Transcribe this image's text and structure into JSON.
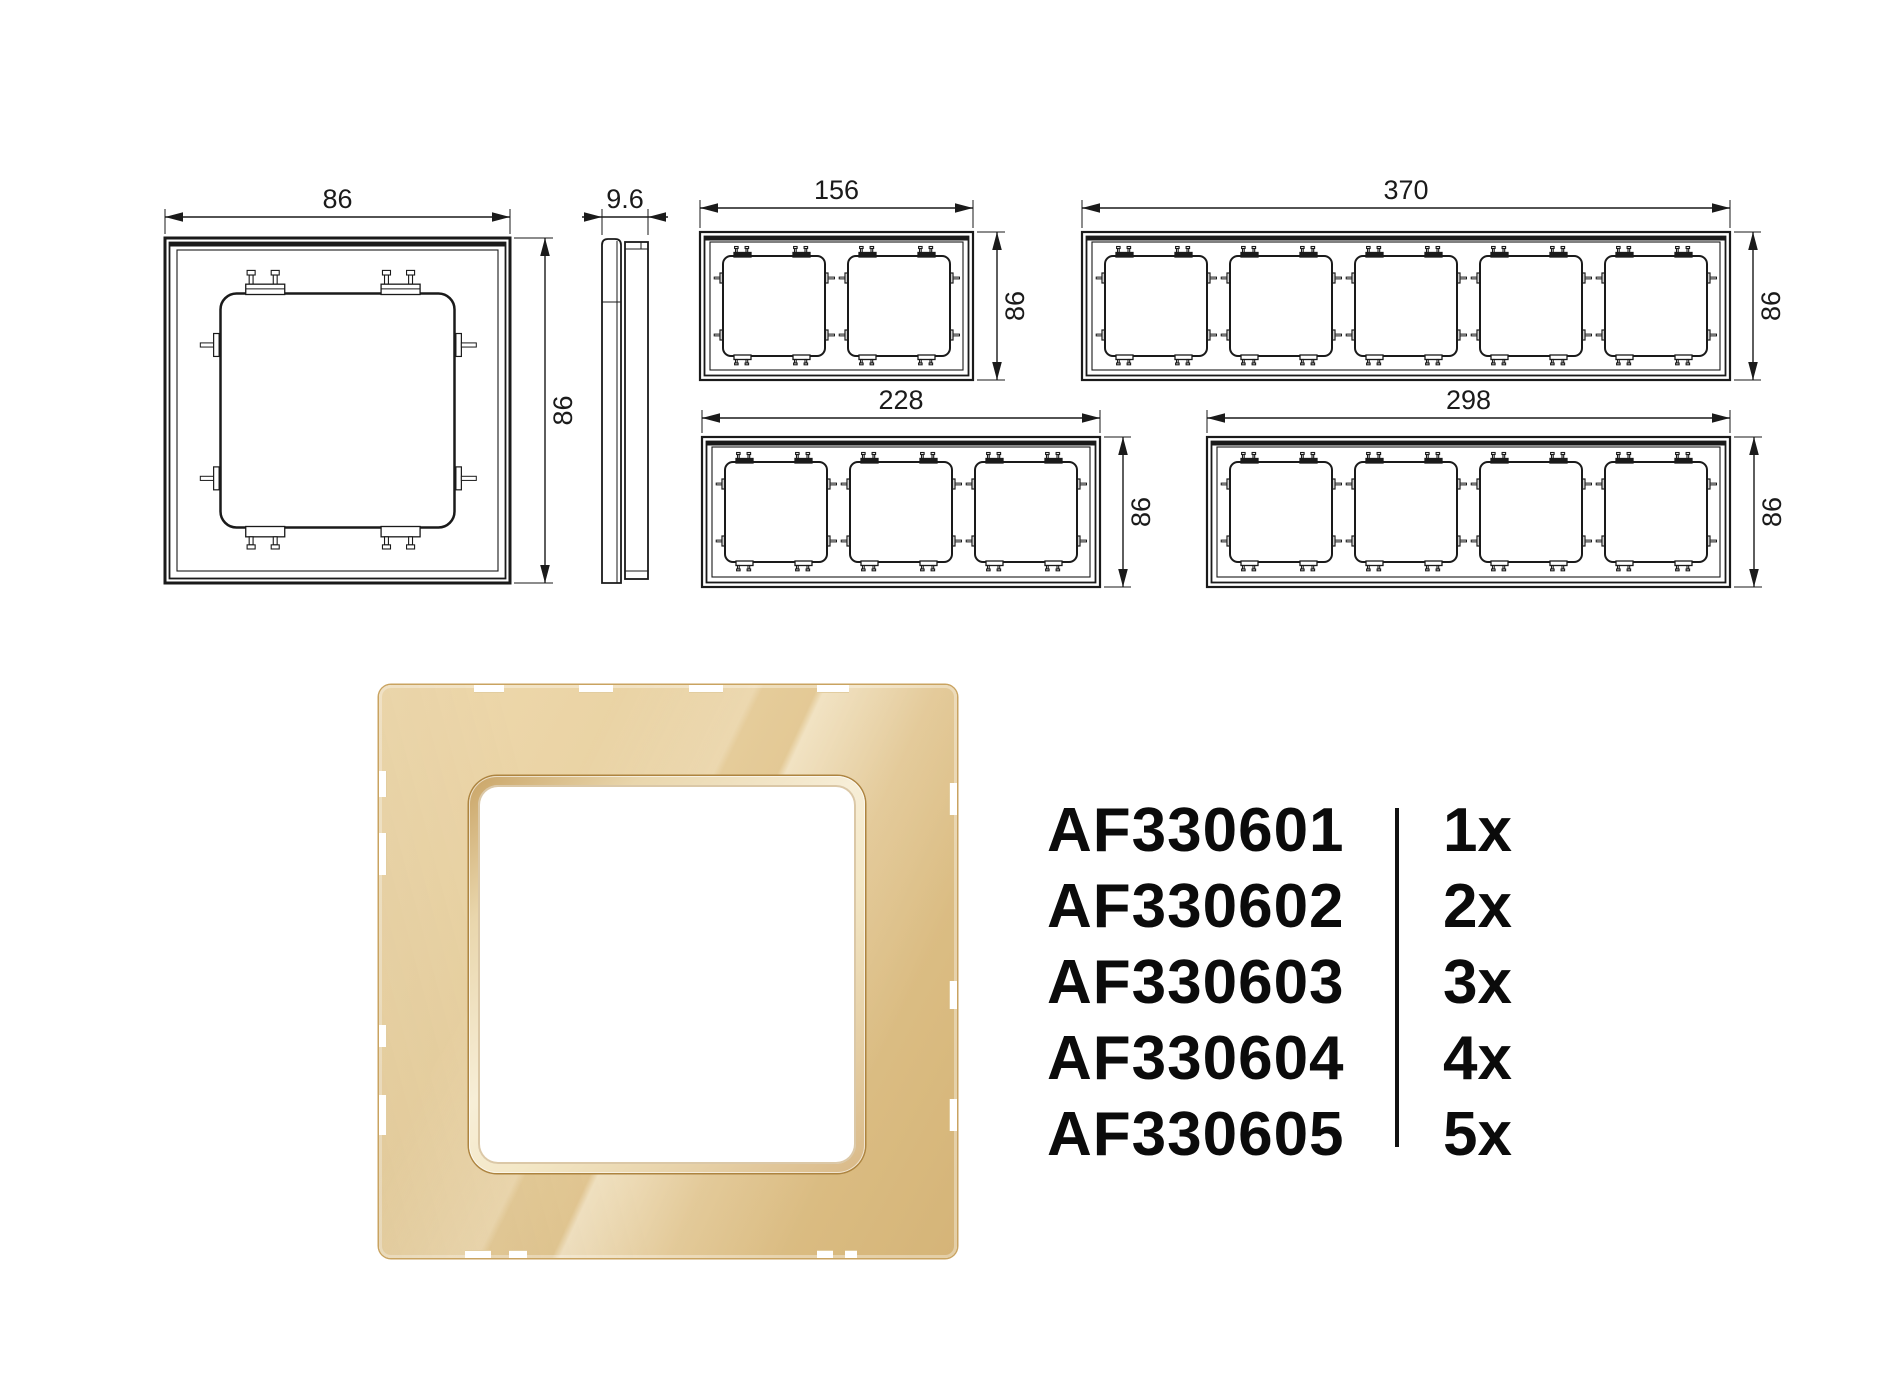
{
  "colors": {
    "line": "#1a1a1a",
    "text": "#0b0b0b",
    "background": "#ffffff",
    "gold_light": "#eed9ae",
    "gold_mid": "#e4ca97",
    "gold_dark": "#d5b478",
    "gold_edge": "#c9a360"
  },
  "technical": {
    "dim_font_size": 27,
    "frames": [
      {
        "name": "frame-1gang",
        "gangs": 1,
        "x": 165,
        "y": 238,
        "w": 345,
        "h": 345,
        "dim_top": "86",
        "dim_top_y": 217,
        "dim_right": "86",
        "dim_right_x": 545,
        "opening": {
          "w": 234,
          "h": 234,
          "margin": 55.5,
          "gap": 0
        },
        "tab_style": "outline"
      },
      {
        "name": "frame-2gang",
        "gangs": 2,
        "x": 700,
        "y": 232,
        "w": 273,
        "h": 148,
        "dim_top": "156",
        "dim_top_y": 208,
        "dim_right": "86",
        "dim_right_x": 997,
        "opening": {
          "w": 102,
          "h": 100,
          "margin": 23,
          "gap": 23
        },
        "tab_style": "filled"
      },
      {
        "name": "frame-5gang",
        "gangs": 5,
        "x": 1082,
        "y": 232,
        "w": 648,
        "h": 148,
        "dim_top": "370",
        "dim_top_y": 208,
        "dim_right": "86",
        "dim_right_x": 1753,
        "opening": {
          "w": 102,
          "h": 100,
          "margin": 23,
          "gap": 23
        },
        "tab_style": "filled"
      },
      {
        "name": "frame-3gang",
        "gangs": 3,
        "x": 702,
        "y": 437,
        "w": 398,
        "h": 150,
        "dim_top": "228",
        "dim_top_y": 418,
        "dim_right": "86",
        "dim_right_x": 1123,
        "opening": {
          "w": 102,
          "h": 100,
          "margin": 23,
          "gap": 23
        },
        "tab_style": "filled"
      },
      {
        "name": "frame-4gang",
        "gangs": 4,
        "x": 1207,
        "y": 437,
        "w": 523,
        "h": 150,
        "dim_top": "298",
        "dim_top_y": 418,
        "dim_right": "86",
        "dim_right_x": 1754,
        "opening": {
          "w": 102,
          "h": 100,
          "margin": 23,
          "gap": 23
        },
        "tab_style": "filled"
      }
    ],
    "profile": {
      "name": "profile-view",
      "x": 602,
      "y": 239,
      "w": 46,
      "h": 344,
      "dim_top": "9.6",
      "dim_top_y": 217
    }
  },
  "render": {
    "x": 379,
    "y": 685,
    "w": 578,
    "h": 573,
    "bevel": {
      "x": 90,
      "y": 91,
      "w": 396,
      "h": 397
    },
    "notches": {
      "top": [
        {
          "x": 95,
          "w": 30
        },
        {
          "x": 200,
          "w": 34
        },
        {
          "x": 310,
          "w": 34
        },
        {
          "x": 438,
          "w": 32
        }
      ],
      "bottom": [
        {
          "x": 86,
          "w": 26
        },
        {
          "x": 130,
          "w": 18
        },
        {
          "x": 438,
          "w": 16
        },
        {
          "x": 466,
          "w": 12
        }
      ],
      "left": [
        {
          "y": 86,
          "h": 26
        },
        {
          "y": 148,
          "h": 42
        },
        {
          "y": 340,
          "h": 22
        },
        {
          "y": 410,
          "h": 40
        }
      ],
      "right": [
        {
          "y": 98,
          "h": 32
        },
        {
          "y": 296,
          "h": 28
        },
        {
          "y": 414,
          "h": 32
        }
      ]
    }
  },
  "code_list": {
    "x": 1047,
    "y": 792,
    "row_height": 76,
    "divider": {
      "x": 348,
      "top": 16,
      "width": 4,
      "height": 339
    },
    "items": [
      {
        "code": "AF330601",
        "qty": "1x"
      },
      {
        "code": "AF330602",
        "qty": "2x"
      },
      {
        "code": "AF330603",
        "qty": "3x"
      },
      {
        "code": "AF330604",
        "qty": "4x"
      },
      {
        "code": "AF330605",
        "qty": "5x"
      }
    ]
  }
}
